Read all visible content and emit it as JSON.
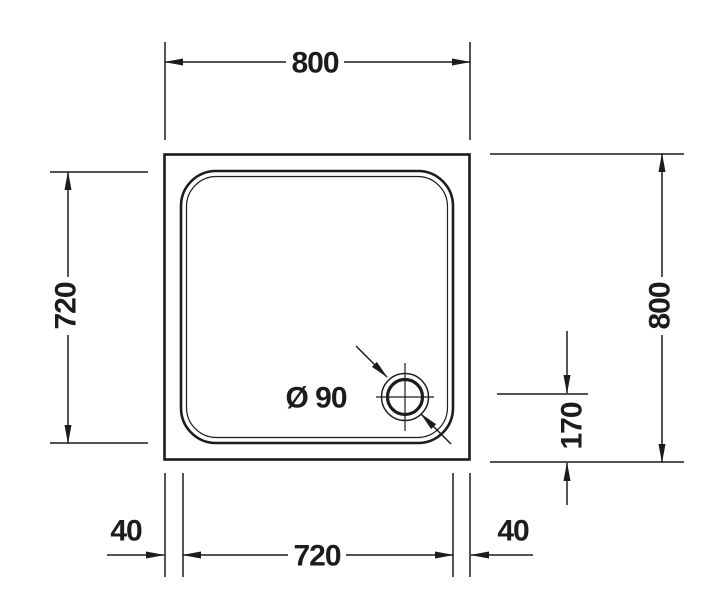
{
  "colors": {
    "background": "#ffffff",
    "line": "#1c1c1c"
  },
  "dimensions": {
    "top_width": "800",
    "left_inner_height": "720",
    "right_height": "800",
    "drain_center_offset": "170",
    "drain_diameter": "Ø 90",
    "bottom_left_rim": "40",
    "bottom_inner_width": "720",
    "bottom_right_rim": "40"
  }
}
